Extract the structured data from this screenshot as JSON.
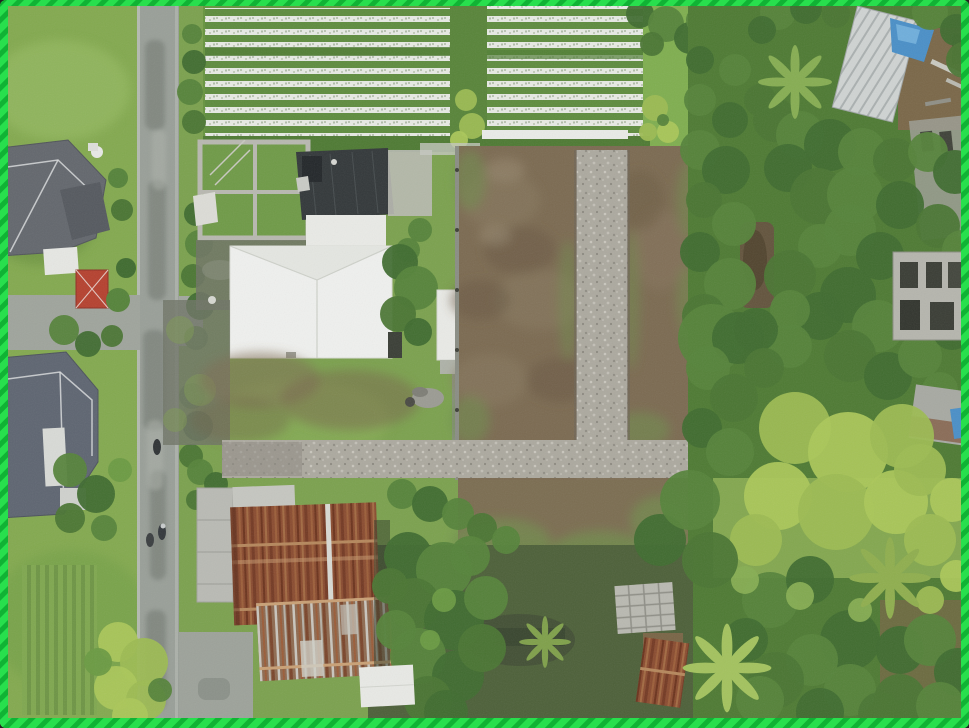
{
  "meta": {
    "type": "aerial-drone-photograph",
    "subject": "top-down drone view of a vacant land plot bordered by a village road, houses, a mulched farm field and dense tropical trees",
    "border_note": "bright green dashed selection border around the photo"
  },
  "frame": {
    "border_color": "#28DF4D",
    "border_dash_color": "#10B334",
    "border_style": "dashed"
  },
  "palette": {
    "grass": "#7BA14E",
    "grass_light": "#8FB35A",
    "field_green": "#5E8C3E",
    "mulch_white": "#E7EAE4",
    "road": "#999F98",
    "road_light": "#BAC0B8",
    "dirt": "#7B6A51",
    "dirt_dark": "#68583F",
    "gravel": "#ACA99F",
    "white_roof": "#EFF0EE",
    "dark_roof": "#33383A",
    "rust_roof": "#8A4C30",
    "house_roof": "#63676D",
    "red_roof": "#B5412F",
    "tree_dark": "#3F6B2F",
    "tree_mid": "#55833A",
    "tree_light": "#6A9A42",
    "bamboo": "#9CBB52",
    "blue_tarp": "#4A8FC7",
    "concrete": "#B5B5AD",
    "mud": "#63543D"
  },
  "regions": [
    {
      "name": "farm-field",
      "desc": "horizontal rows of white plastic mulch beds, top center"
    },
    {
      "name": "village-road",
      "desc": "vertical asphalt road on the left with motorbikes"
    },
    {
      "name": "houses-top-left",
      "desc": "dark tiled hip roofs, white sections, small red gazebo roof"
    },
    {
      "name": "house-mid-left",
      "desc": "blue-gray tiled hip roof house"
    },
    {
      "name": "concrete-frame-structure",
      "desc": "unfinished concrete building frame"
    },
    {
      "name": "dark-roof-building",
      "desc": "black corrugated roof workshop"
    },
    {
      "name": "white-roof-building",
      "desc": "large white hip roof house in center"
    },
    {
      "name": "land-plot",
      "desc": "cleared brown dirt plot with T-shaped gravel paths"
    },
    {
      "name": "right-jungle",
      "desc": "dense tropical trees, bamboo and palms on the right"
    },
    {
      "name": "metal-shed",
      "desc": "corrugated metal shed with blue tarp, top right"
    },
    {
      "name": "rusty-roof-building",
      "desc": "long rusted corrugated roof house, bottom left of center"
    },
    {
      "name": "big-tree",
      "desc": "large dark canopy beside the rusty building"
    },
    {
      "name": "materials-stack",
      "desc": "stacked concrete blocks in bottom middle"
    },
    {
      "name": "banana-palms",
      "desc": "star-shaped banana and palm crowns, bottom right"
    }
  ]
}
